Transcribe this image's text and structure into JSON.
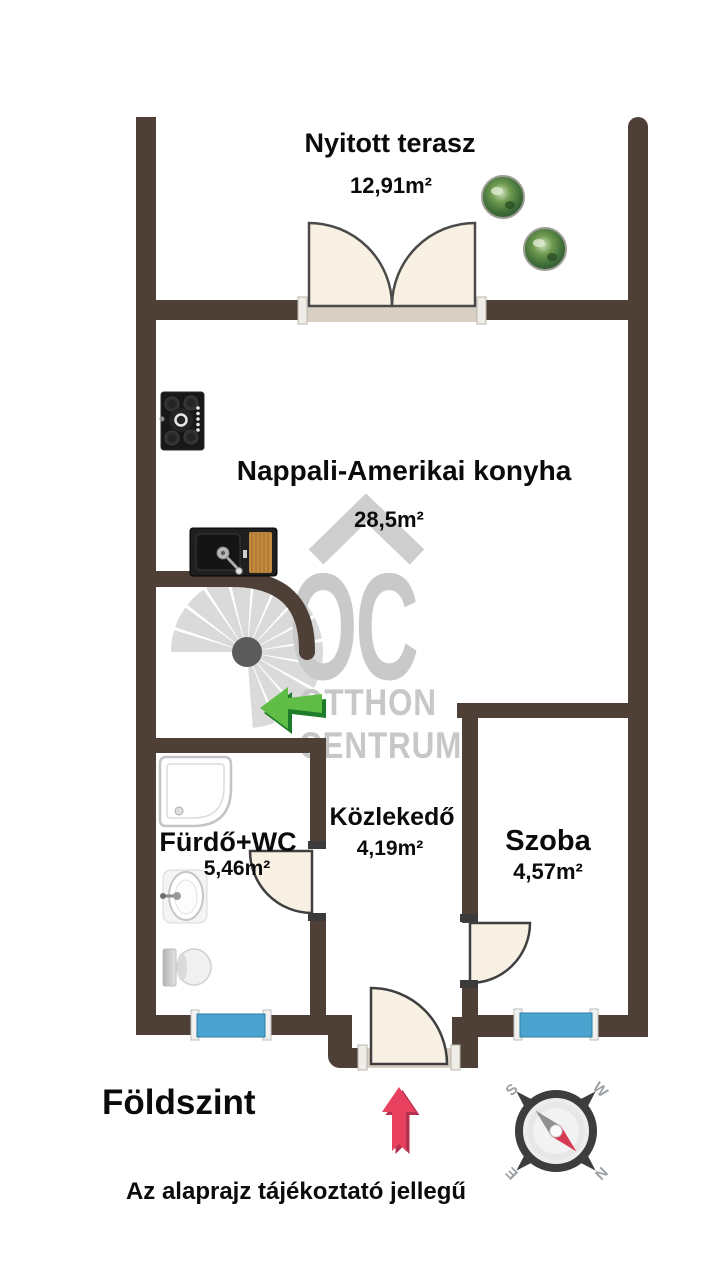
{
  "rooms": {
    "terrace": {
      "name": "Nyitott terasz",
      "area": "12,91m²"
    },
    "living": {
      "name": "Nappali-Amerikai konyha",
      "area": "28,5m²"
    },
    "bathroom": {
      "name": "Fürdő+WC",
      "area": "5,46m²"
    },
    "hallway": {
      "name": "Közlekedő",
      "area": "4,19m²"
    },
    "room": {
      "name": "Szoba",
      "area": "4,57m²"
    }
  },
  "footer": {
    "floor_label": "Földszint",
    "disclaimer": "Az alaprajz tájékoztató jellegű"
  },
  "watermark": {
    "initials": "OC",
    "line1": "OTTHON",
    "line2": "CENTRUM"
  },
  "compass": {
    "north": "N",
    "south": "S",
    "east": "E",
    "west": "W"
  },
  "colors": {
    "wall": "#4e4037",
    "door_fill": "#f8f0e3",
    "sill": "#d8d0c3",
    "radiator_blue": "#4ba3cf",
    "stairs_gray": "#dadada",
    "watermark_gray": "#c9c9c9",
    "logo_green": "#5fbc45",
    "logo_green_dark": "#1e7b2a",
    "entry_arrow_red": "#e8415f",
    "compass_needle_red": "#d63a52"
  }
}
